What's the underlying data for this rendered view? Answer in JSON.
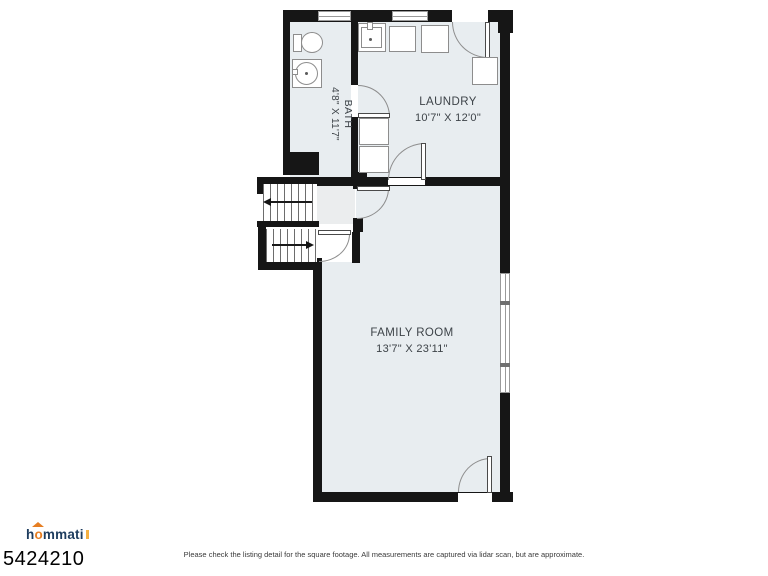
{
  "branding": {
    "logo_prefix": "h",
    "logo_accent": "o",
    "logo_suffix": "mmati",
    "navy": "#1d3c5e",
    "orange": "#e67e22"
  },
  "listing": {
    "id": "5424210",
    "disclaimer": "Please check the listing detail for the square footage. All measurements are captured via lidar scan, but are approximate."
  },
  "floorplan": {
    "colors": {
      "wall": "#161616",
      "floor": "#e8edf0",
      "line": "#8d8d8d",
      "label": "#3d4348"
    },
    "rooms": {
      "bath": {
        "name": "BATH",
        "dims": "4'8\" X 11'7\""
      },
      "laundry": {
        "name": "LAUNDRY",
        "dims": "10'7\" X 12'0\""
      },
      "family": {
        "name": "FAMILY ROOM",
        "dims": "13'7\" X 23'11\""
      }
    },
    "fixtures": [
      "toilet",
      "pedestal-sink",
      "utility-sink",
      "washer",
      "dryer",
      "water-heater",
      "stacked-laundry-units"
    ],
    "stairs": [
      "upper-flight-arrow-left",
      "lower-flight-arrow-right"
    ]
  }
}
